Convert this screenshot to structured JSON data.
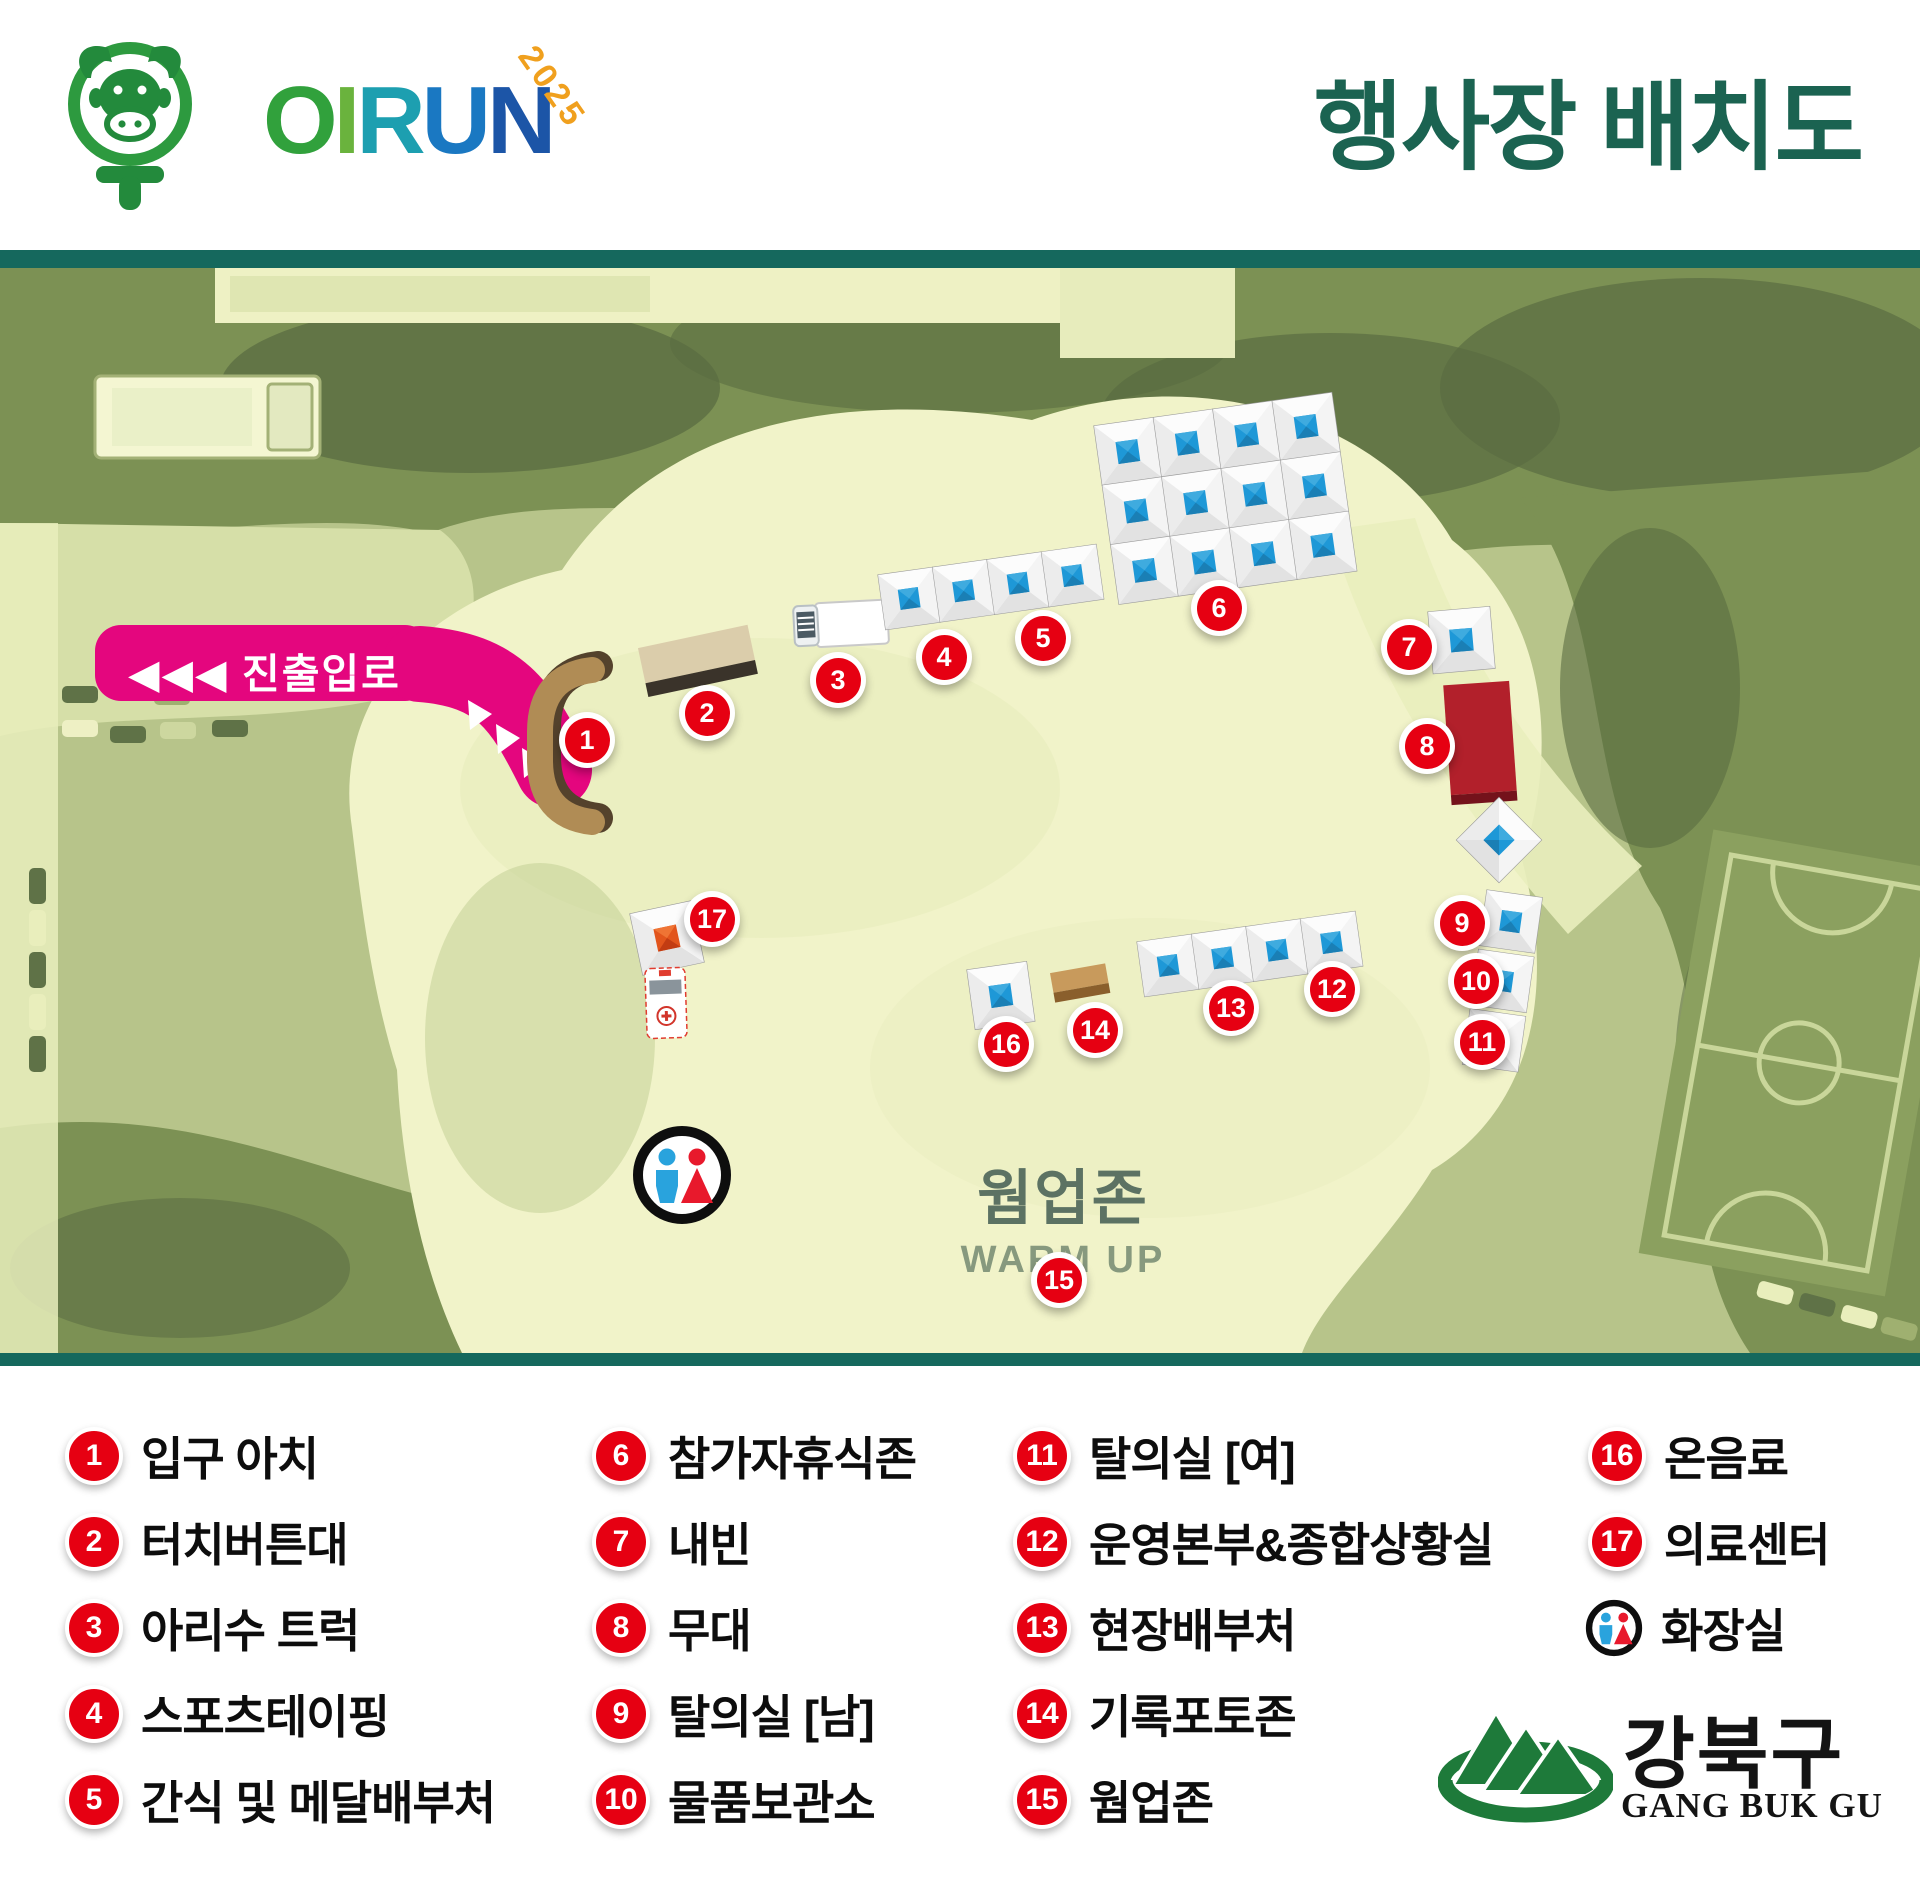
{
  "header": {
    "logo_letters": [
      "O",
      "I",
      "R",
      "U",
      "N"
    ],
    "logo_year": "2025",
    "title": "행사장 배치도"
  },
  "map": {
    "entrance_label": "◀◀◀  진출입로",
    "warmup_korean": "웜업존",
    "warmup_english": "WARM UP",
    "markers": [
      "1",
      "2",
      "3",
      "4",
      "5",
      "6",
      "7",
      "8",
      "9",
      "10",
      "11",
      "12",
      "13",
      "14",
      "15",
      "16",
      "17"
    ]
  },
  "legend": {
    "items": [
      {
        "num": "1",
        "label": "입구 아치"
      },
      {
        "num": "2",
        "label": "터치버튼대"
      },
      {
        "num": "3",
        "label": "아리수 트럭"
      },
      {
        "num": "4",
        "label": "스포츠테이핑"
      },
      {
        "num": "5",
        "label": "간식 및 메달배부처"
      },
      {
        "num": "6",
        "label": "참가자휴식존"
      },
      {
        "num": "7",
        "label": "내빈"
      },
      {
        "num": "8",
        "label": "무대"
      },
      {
        "num": "9",
        "label": "탈의실 [남]"
      },
      {
        "num": "10",
        "label": "물품보관소"
      },
      {
        "num": "11",
        "label": "탈의실 [여]"
      },
      {
        "num": "12",
        "label": "운영본부&종합상황실"
      },
      {
        "num": "13",
        "label": "현장배부처"
      },
      {
        "num": "14",
        "label": "기록포토존"
      },
      {
        "num": "15",
        "label": "웜업존"
      },
      {
        "num": "16",
        "label": "온음료"
      },
      {
        "num": "17",
        "label": "의료센터"
      }
    ],
    "toilet_label": "화장실"
  },
  "footer": {
    "gu_korean": "강북구",
    "gu_english": "GANG BUK GU"
  }
}
